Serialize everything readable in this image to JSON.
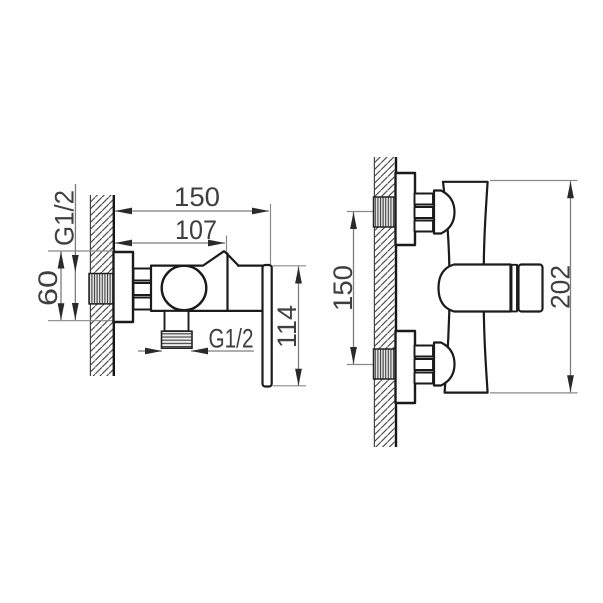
{
  "drawing": {
    "type": "technical-installation-drawing",
    "subject": "wall-mounted shower mixer faucet, side view and front view with dimensions",
    "colors": {
      "background": "#ffffff",
      "part_line": "#1b1b1b",
      "dimension_line": "#7d7d7d",
      "arrow": "#2a2a2a",
      "text": "#3f3f3f"
    },
    "side_view": {
      "dims": {
        "total_depth": "150",
        "body_depth": "107",
        "wall_thread": "G1/2",
        "flange_height": "60",
        "outlet_thread": "G1/2",
        "handle_height": "114"
      }
    },
    "front_view": {
      "dims": {
        "connection_spacing": "150",
        "total_height": "202"
      }
    }
  }
}
